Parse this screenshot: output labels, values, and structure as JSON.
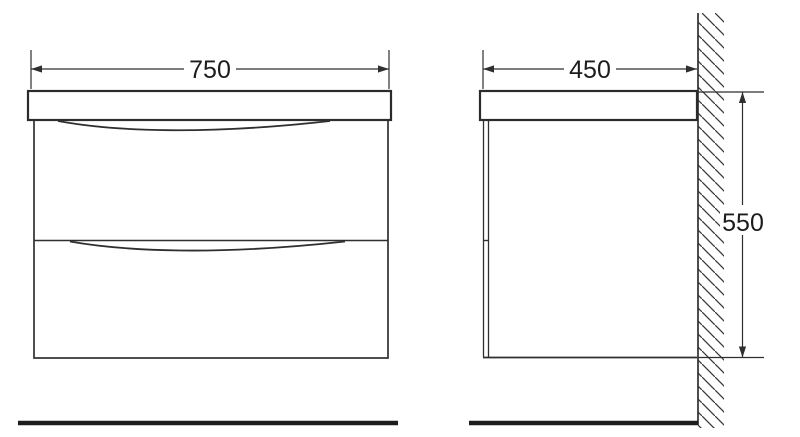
{
  "front_view": {
    "width_label": "750"
  },
  "side_view": {
    "depth_label": "450",
    "height_label": "550"
  },
  "colors": {
    "background": "#ffffff",
    "line": "#2f2f2f",
    "floor_line": "#1d1d1d",
    "text": "#1c1c1c"
  }
}
